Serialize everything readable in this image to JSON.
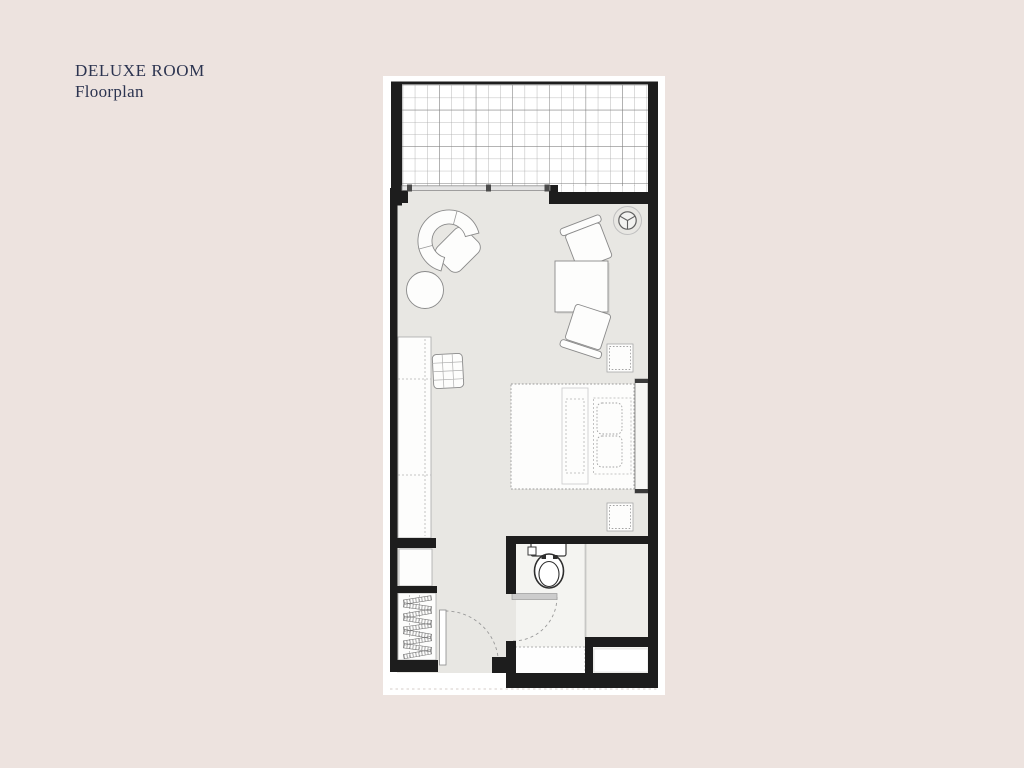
{
  "header": {
    "title": "DELUXE ROOM",
    "subtitle": "Floorplan"
  },
  "colors": {
    "bg": "#ede3df",
    "title": "#2c3450",
    "wall": "#1d1d1d",
    "sheet": "#ffffff",
    "floor": "#e8e7e3",
    "floor_bath": "#f4f4f1",
    "floor_shower": "#eeede9",
    "outline": "#8a8a8a",
    "grid": "#a6a6a6",
    "grid_dark": "#7c7c7c",
    "furn": "#fdfdfc",
    "dash": "#b3b3b3",
    "window": "#e4e4e4",
    "door": "#cccccc",
    "sheet_edge": "#d6cec9"
  },
  "plan": {
    "label": "deluxe-room-floorplan",
    "elements": [
      "terrace-grid",
      "sliding-window",
      "ceiling-light-icon",
      "armchair",
      "ottoman",
      "lounge-chair-upper",
      "coffee-table",
      "lounge-chair-lower",
      "side-table",
      "wardrobe",
      "rattan-stool",
      "bed",
      "headboard",
      "nightstand-upper",
      "nightstand-lower",
      "storage-cabinet",
      "hanging-closet",
      "entry-door",
      "toilet-icon",
      "bathroom-door",
      "shower-divider",
      "vanity",
      "storage-niche"
    ]
  }
}
